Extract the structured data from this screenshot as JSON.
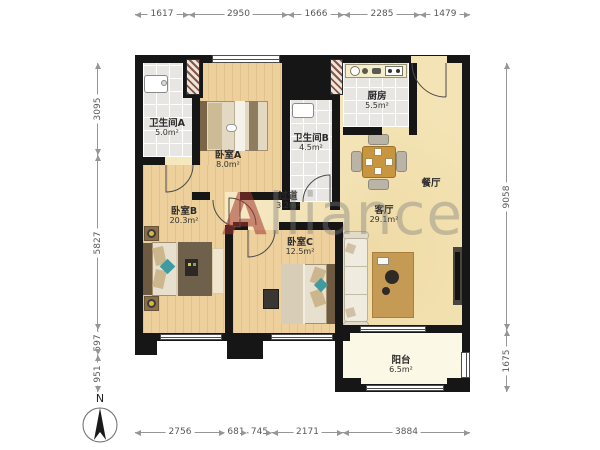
{
  "watermark": {
    "lead": "A",
    "rest": "lliance"
  },
  "compass": {
    "north_label": "N"
  },
  "rooms": {
    "bathroom_a": {
      "name": "卫生间A",
      "area": "5.0m²"
    },
    "bedroom_a": {
      "name": "卧室A",
      "area": "8.0m²"
    },
    "bathroom_b": {
      "name": "卫生间B",
      "area": "4.5m²"
    },
    "kitchen": {
      "name": "厨房",
      "area": "5.5m²"
    },
    "dining": {
      "name": "餐厅"
    },
    "hallway": {
      "name": "过道",
      "area": "3.2m²"
    },
    "bedroom_b": {
      "name": "卧室B",
      "area": "20.3m²"
    },
    "bedroom_c": {
      "name": "卧室C",
      "area": "12.5m²"
    },
    "living": {
      "name": "客厅",
      "area": "29.1m²"
    },
    "balcony": {
      "name": "阳台",
      "area": "6.5m²"
    }
  },
  "dimensions": {
    "top": [
      "1617",
      "2950",
      "1666",
      "2285",
      "1479"
    ],
    "bottom": [
      "2756",
      "681",
      "745",
      "2171",
      "3884"
    ],
    "left": [
      "3095",
      "5827",
      "597",
      "951"
    ],
    "right": [
      "9058",
      "1675"
    ]
  },
  "colors": {
    "wall": "#161616",
    "wood_floor": "#edd09c",
    "open_area_floor": "#f4e4b5",
    "tile_floor": "#e7e6e2",
    "balcony_floor": "#fcf8e6",
    "watermark_gray": "#7d7d7d",
    "watermark_red": "#a0372d"
  }
}
